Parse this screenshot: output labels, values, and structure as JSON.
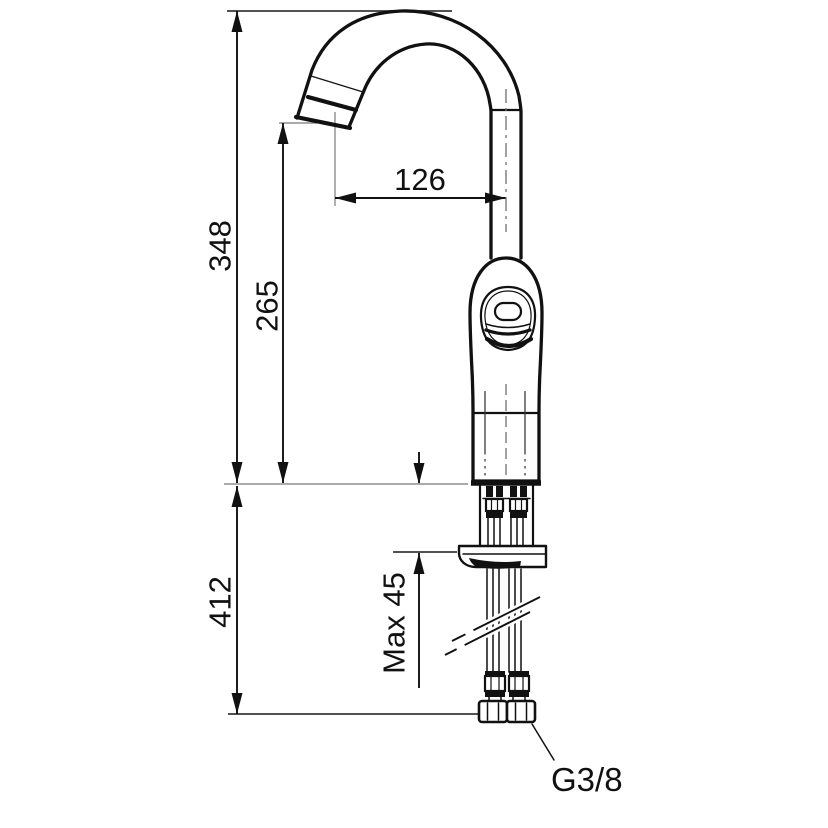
{
  "drawing": {
    "colors": {
      "ink": "#111111",
      "reference": "#8f8f8f",
      "background": "#ffffff"
    },
    "labels": {
      "height_total": "348",
      "height_outlet": "265",
      "reach": "126",
      "hose_length": "412",
      "max_thickness": "Max 45",
      "thread": "G3/8"
    }
  }
}
